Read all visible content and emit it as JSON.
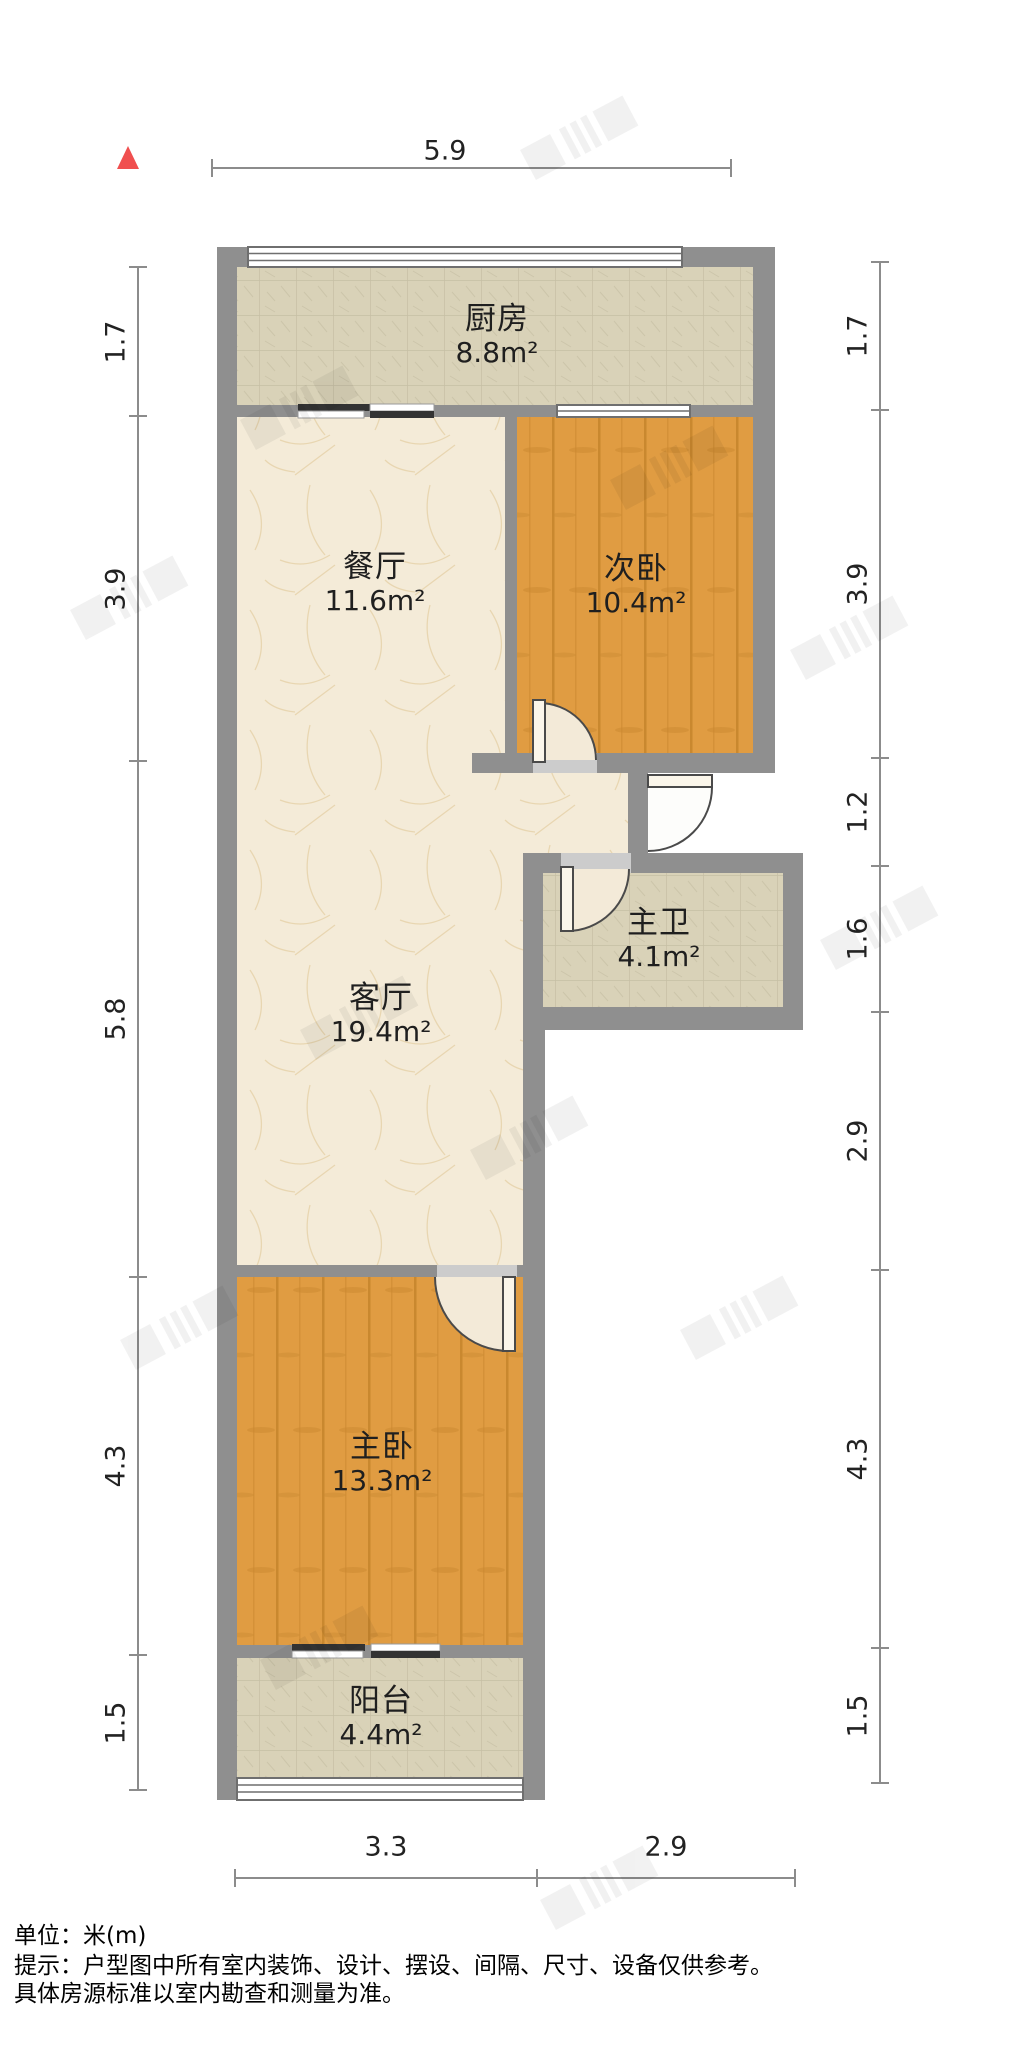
{
  "plan": {
    "title": "户型图",
    "north_icon": "north-arrow-triangle"
  },
  "rooms": [
    {
      "name": "厨房",
      "area": "8.8m²"
    },
    {
      "name": "餐厅",
      "area": "11.6m²"
    },
    {
      "name": "次卧",
      "area": "10.4m²"
    },
    {
      "name": "主卫",
      "area": "4.1m²"
    },
    {
      "name": "客厅",
      "area": "19.4m²"
    },
    {
      "name": "主卧",
      "area": "13.3m²"
    },
    {
      "name": "阳台",
      "area": "4.4m²"
    }
  ],
  "dimensions": {
    "top": [
      "5.9"
    ],
    "bottom": [
      "3.3",
      "2.9"
    ],
    "left": [
      "1.7",
      "3.9",
      "5.8",
      "4.3",
      "1.5"
    ],
    "right": [
      "1.7",
      "3.9",
      "1.2",
      "1.6",
      "2.9",
      "4.3",
      "1.5"
    ]
  },
  "footer": {
    "unit": "单位：米(m)",
    "tip_line1": "提示：户型图中所有室内装饰、设计、摆设、间隔、尺寸、设备仅供参考。",
    "tip_line2": "具体房源标准以室内勘查和测量为准。"
  },
  "colors": {
    "wall": "#8f8f8f",
    "lintel": "#cccccc",
    "line": "#6f6f6f",
    "doorline": "#4a4a4a",
    "leaf": "#fbf6ea",
    "swing": "#f3ead8",
    "dimline": "#8c8c8c",
    "tile": "#d9d2b8",
    "tileline": "#c6bfa4",
    "wood": "#e09c42",
    "woodgrain": "#c9882f",
    "marble": "#f4ebd8",
    "marblevein": "#e6d2ab",
    "north": "#f04f4f",
    "text": "#1f1f1f"
  }
}
